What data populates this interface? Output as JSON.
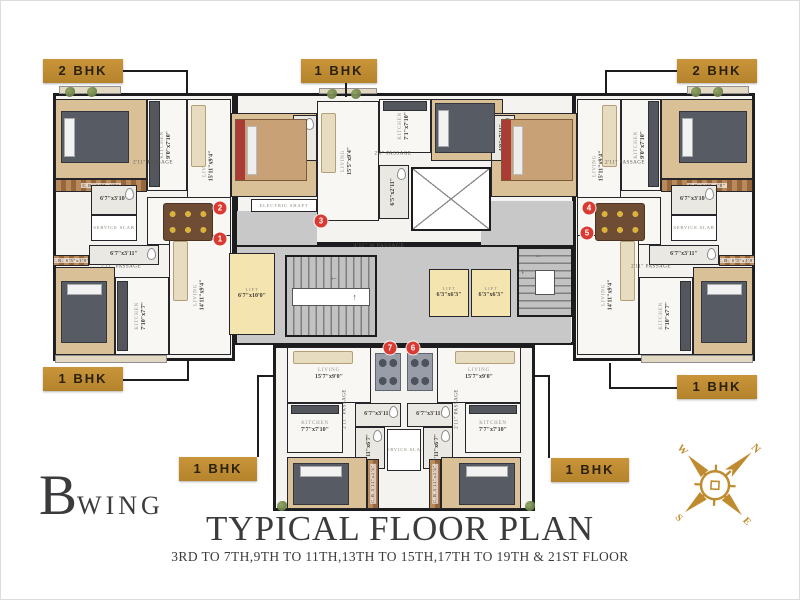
{
  "meta": {
    "wing_big": "B",
    "wing_small": "WING",
    "title": "TYPICAL FLOOR PLAN",
    "subtitle": "3RD TO 7TH,9TH TO 11TH,13TH TO 15TH,17TH TO 19TH & 21ST FLOOR"
  },
  "colors": {
    "tag_gold": "#bf8b2e",
    "wall_black": "#1d1d1f",
    "marker_red": "#d93a32",
    "wood_floor": "#d9c096",
    "lift_cream": "#f4e4b0",
    "passage_gray": "#c8c8c8",
    "title_gray": "#3b3b3e",
    "compass_gold": "#bf8b2e"
  },
  "compass": {
    "letters": {
      "n": "N",
      "e": "E",
      "s": "S",
      "w": "W"
    }
  },
  "tags": [
    {
      "label": "2 BHK",
      "x": 42,
      "y": 58,
      "w": 80,
      "h": 24,
      "lines": [
        [
          122,
          69,
          186,
          69
        ],
        [
          185,
          69,
          185,
          94
        ]
      ]
    },
    {
      "label": "1 BHK",
      "x": 300,
      "y": 58,
      "w": 76,
      "h": 24,
      "lines": [
        [
          344,
          82,
          344,
          96
        ]
      ]
    },
    {
      "label": "2 BHK",
      "x": 676,
      "y": 58,
      "w": 80,
      "h": 24,
      "lines": [
        [
          604,
          69,
          676,
          69
        ],
        [
          604,
          69,
          604,
          94
        ]
      ]
    },
    {
      "label": "1 BHK",
      "x": 42,
      "y": 366,
      "w": 80,
      "h": 24,
      "lines": [
        [
          122,
          378,
          188,
          378
        ],
        [
          186,
          360,
          186,
          378
        ]
      ]
    },
    {
      "label": "1 BHK",
      "x": 676,
      "y": 374,
      "w": 80,
      "h": 24,
      "lines": [
        [
          608,
          386,
          676,
          386
        ],
        [
          608,
          362,
          608,
          386
        ]
      ]
    },
    {
      "label": "1 BHK",
      "x": 178,
      "y": 456,
      "w": 78,
      "h": 24,
      "lines": [
        [
          256,
          374,
          256,
          456
        ],
        [
          256,
          374,
          272,
          374
        ]
      ]
    },
    {
      "label": "1 BHK",
      "x": 550,
      "y": 457,
      "w": 78,
      "h": 24,
      "lines": [
        [
          547,
          374,
          547,
          457
        ],
        [
          534,
          374,
          547,
          374
        ]
      ]
    }
  ],
  "plan": {
    "outline": [
      {
        "x": 52,
        "y": 92,
        "w": 182,
        "h": 268
      },
      {
        "x": 234,
        "y": 92,
        "w": 340,
        "h": 152
      },
      {
        "x": 572,
        "y": 92,
        "w": 182,
        "h": 268
      },
      {
        "x": 234,
        "y": 244,
        "w": 340,
        "h": 100
      },
      {
        "x": 272,
        "y": 344,
        "w": 262,
        "h": 166
      }
    ],
    "grays": [
      {
        "x": 236,
        "y": 246,
        "w": 334,
        "h": 96
      },
      {
        "x": 236,
        "y": 210,
        "w": 80,
        "h": 34
      },
      {
        "x": 480,
        "y": 200,
        "w": 92,
        "h": 44
      }
    ],
    "rooms": [
      {
        "n": "BEDROOM",
        "d": "10'0\"x9'4\"",
        "x": 54,
        "y": 98,
        "w": 92,
        "h": 80,
        "f": "wood",
        "r": 90
      },
      {
        "n": "C.B. 6'5\"x1'8\"",
        "x": 54,
        "y": 178,
        "w": 92,
        "h": 13,
        "f": "cb"
      },
      {
        "n": "KITCHEN",
        "d": "9'0\"x7'10\"",
        "x": 146,
        "y": 98,
        "w": 40,
        "h": 92,
        "f": "marble",
        "r": 90
      },
      {
        "n": "LIVING",
        "d": "15'11\"x9'4\"",
        "x": 186,
        "y": 98,
        "w": 44,
        "h": 134,
        "f": "marble",
        "r": 90
      },
      {
        "n": "BEDROOM",
        "d": "12'0\"x9'4\"",
        "x": 230,
        "y": 112,
        "w": 86,
        "h": 84,
        "f": "wood",
        "r": 90
      },
      {
        "d": "4'0\"x7'11\"",
        "x": 292,
        "y": 114,
        "w": 24,
        "h": 46,
        "f": "tile",
        "r": 90,
        "wc": 1
      },
      {
        "d": "6'7\"x3'10\"",
        "x": 90,
        "y": 184,
        "w": 46,
        "h": 30,
        "f": "tile",
        "wc": 1
      },
      {
        "n": "SERVICE SLAB",
        "x": 90,
        "y": 214,
        "w": 46,
        "h": 26,
        "f": "white"
      },
      {
        "n": "DINING",
        "d": "4'5\"x6'11\"",
        "x": 146,
        "y": 196,
        "w": 84,
        "h": 48,
        "f": "marble"
      },
      {
        "n": "ELECTRIC SHAFT",
        "x": 250,
        "y": 198,
        "w": 66,
        "h": 13,
        "f": "white"
      },
      {
        "d": "6'7\"x3'11\"",
        "x": 88,
        "y": 244,
        "w": 70,
        "h": 20,
        "f": "tile",
        "wc": 1
      },
      {
        "n": "C.B. 6'5\"x1'8\"",
        "x": 52,
        "y": 254,
        "w": 36,
        "h": 11,
        "f": "cb"
      },
      {
        "n": "BEDROOM",
        "d": "10'0\"x9'4\"",
        "x": 54,
        "y": 266,
        "w": 60,
        "h": 88,
        "f": "wood",
        "r": 90
      },
      {
        "n": "KITCHEN",
        "d": "7'10\"x7'7\"",
        "x": 114,
        "y": 276,
        "w": 54,
        "h": 78,
        "f": "marble",
        "r": 90
      },
      {
        "n": "LIVING",
        "d": "14'11\"x9'4\"",
        "x": 168,
        "y": 234,
        "w": 62,
        "h": 120,
        "f": "marble",
        "r": 90
      },
      {
        "n": "LIVING",
        "d": "15'5\"x9'4\"",
        "x": 316,
        "y": 100,
        "w": 62,
        "h": 120,
        "f": "marble",
        "r": 90
      },
      {
        "n": "KITCHEN",
        "d": "7'1\"x7'10\"",
        "x": 378,
        "y": 98,
        "w": 52,
        "h": 54,
        "f": "marble",
        "r": 90
      },
      {
        "n": "BEDROOM",
        "d": "10'0\"x9'4\"",
        "x": 430,
        "y": 98,
        "w": 72,
        "h": 62,
        "f": "wood",
        "r": 90
      },
      {
        "d": "6'5\"x2'11\"",
        "x": 378,
        "y": 164,
        "w": 30,
        "h": 54,
        "f": "tile",
        "r": 90,
        "wc": 1
      },
      {
        "n": "BEDROOM",
        "d": "10'0\"x9'4\"",
        "x": 660,
        "y": 98,
        "w": 92,
        "h": 80,
        "f": "wood",
        "r": 90
      },
      {
        "n": "C.B. 6'5\"x1'8\"",
        "x": 660,
        "y": 178,
        "w": 92,
        "h": 13,
        "f": "cb"
      },
      {
        "n": "KITCHEN",
        "d": "9'0\"x7'10\"",
        "x": 620,
        "y": 98,
        "w": 40,
        "h": 92,
        "f": "marble",
        "r": 90
      },
      {
        "n": "LIVING",
        "d": "15'11\"x9'4\"",
        "x": 576,
        "y": 98,
        "w": 44,
        "h": 134,
        "f": "marble",
        "r": 90
      },
      {
        "n": "BEDROOM",
        "d": "12'0\"x9'4\"",
        "x": 490,
        "y": 112,
        "w": 86,
        "h": 84,
        "f": "wood",
        "r": 90
      },
      {
        "d": "4'0\"x7'11\"",
        "x": 490,
        "y": 114,
        "w": 24,
        "h": 46,
        "f": "tile",
        "r": 90,
        "wc": 1
      },
      {
        "d": "6'7\"x3'10\"",
        "x": 670,
        "y": 184,
        "w": 46,
        "h": 30,
        "f": "tile",
        "wc": 1
      },
      {
        "n": "SERVICE SLAB",
        "x": 670,
        "y": 214,
        "w": 46,
        "h": 26,
        "f": "white"
      },
      {
        "n": "DINING",
        "d": "4'5\"x6'11\"",
        "x": 576,
        "y": 196,
        "w": 84,
        "h": 48,
        "f": "marble"
      },
      {
        "d": "6'7\"x3'11\"",
        "x": 648,
        "y": 244,
        "w": 70,
        "h": 20,
        "f": "tile",
        "wc": 1
      },
      {
        "n": "C.B. 6'5\"x1'8\"",
        "x": 718,
        "y": 254,
        "w": 36,
        "h": 11,
        "f": "cb"
      },
      {
        "n": "BEDROOM",
        "d": "10'0\"x9'4\"",
        "x": 692,
        "y": 266,
        "w": 60,
        "h": 88,
        "f": "wood",
        "r": 90
      },
      {
        "n": "KITCHEN",
        "d": "7'10\"x7'7\"",
        "x": 638,
        "y": 276,
        "w": 54,
        "h": 78,
        "f": "marble",
        "r": 90
      },
      {
        "n": "LIVING",
        "d": "14'11\"x9'4\"",
        "x": 576,
        "y": 234,
        "w": 62,
        "h": 120,
        "f": "marble",
        "r": 90
      },
      {
        "n": "LIFT",
        "d": "6'7\"x10'0\"",
        "x": 228,
        "y": 252,
        "w": 46,
        "h": 82,
        "f": "lift"
      },
      {
        "n": "LIFT",
        "d": "6'3\"x6'3\"",
        "x": 428,
        "y": 268,
        "w": 40,
        "h": 48,
        "f": "lift"
      },
      {
        "n": "LIFT",
        "d": "6'3\"x6'3\"",
        "x": 470,
        "y": 268,
        "w": 40,
        "h": 48,
        "f": "lift"
      },
      {
        "n": "LIVING",
        "d": "15'7\"x9'0\"",
        "x": 286,
        "y": 346,
        "w": 84,
        "h": 56,
        "f": "marble"
      },
      {
        "n": "KITCHEN",
        "d": "7'7\"x7'10\"",
        "x": 286,
        "y": 402,
        "w": 56,
        "h": 50,
        "f": "marble"
      },
      {
        "d": "6'7\"x3'11\"",
        "x": 354,
        "y": 402,
        "w": 46,
        "h": 24,
        "f": "tile",
        "wc": 1
      },
      {
        "d": "3'11\"x6'7\"",
        "x": 354,
        "y": 426,
        "w": 30,
        "h": 42,
        "f": "tile",
        "r": 90,
        "wc": 1
      },
      {
        "n": "BEDROOM",
        "d": "10'0\"x9'0\"",
        "x": 286,
        "y": 456,
        "w": 80,
        "h": 52,
        "f": "wood"
      },
      {
        "n": "C.B 5'11\"x1'6\"",
        "x": 366,
        "y": 458,
        "w": 12,
        "h": 50,
        "f": "cb",
        "r": 90
      },
      {
        "n": "SERVICE SLAB",
        "x": 386,
        "y": 428,
        "w": 34,
        "h": 42,
        "f": "white"
      },
      {
        "n": "LIVING",
        "d": "15'7\"x9'0\"",
        "x": 436,
        "y": 346,
        "w": 84,
        "h": 56,
        "f": "marble"
      },
      {
        "n": "KITCHEN",
        "d": "7'7\"x7'10\"",
        "x": 464,
        "y": 402,
        "w": 56,
        "h": 50,
        "f": "marble"
      },
      {
        "d": "6'7\"x3'11\"",
        "x": 406,
        "y": 402,
        "w": 46,
        "h": 24,
        "f": "tile",
        "wc": 1
      },
      {
        "d": "3'11\"x6'7\"",
        "x": 422,
        "y": 426,
        "w": 30,
        "h": 42,
        "f": "tile",
        "r": 90,
        "wc": 1
      },
      {
        "n": "BEDROOM",
        "d": "10'0\"x9'0\"",
        "x": 440,
        "y": 456,
        "w": 80,
        "h": 52,
        "f": "wood"
      },
      {
        "n": "C.B 5'11\"x1'6\"",
        "x": 428,
        "y": 458,
        "w": 12,
        "h": 50,
        "f": "cb",
        "r": 90
      },
      {
        "x": 58,
        "y": 85,
        "w": 62,
        "h": 8,
        "f": "balcony"
      },
      {
        "x": 318,
        "y": 87,
        "w": 58,
        "h": 6,
        "f": "balcony"
      },
      {
        "x": 686,
        "y": 85,
        "w": 62,
        "h": 8,
        "f": "balcony"
      },
      {
        "x": 54,
        "y": 354,
        "w": 112,
        "h": 8,
        "f": "balcony"
      },
      {
        "x": 640,
        "y": 354,
        "w": 112,
        "h": 8,
        "f": "balcony"
      }
    ],
    "features": [
      {
        "k": "bed",
        "x": 60,
        "y": 110,
        "w": 68,
        "h": 52
      },
      {
        "k": "bedred",
        "x": 234,
        "y": 118,
        "w": 72,
        "h": 62
      },
      {
        "k": "bed",
        "x": 678,
        "y": 110,
        "w": 68,
        "h": 52
      },
      {
        "k": "bedred",
        "x": 500,
        "y": 118,
        "w": 72,
        "h": 62
      },
      {
        "k": "bedv",
        "x": 60,
        "y": 280,
        "w": 46,
        "h": 62
      },
      {
        "k": "bedv",
        "x": 700,
        "y": 280,
        "w": 46,
        "h": 62
      },
      {
        "k": "bed",
        "x": 434,
        "y": 102,
        "w": 60,
        "h": 50
      },
      {
        "k": "bedv",
        "x": 292,
        "y": 462,
        "w": 56,
        "h": 42
      },
      {
        "k": "bedv",
        "x": 458,
        "y": 462,
        "w": 56,
        "h": 42
      },
      {
        "k": "table6",
        "x": 162,
        "y": 202,
        "w": 50,
        "h": 38
      },
      {
        "k": "table6",
        "x": 594,
        "y": 202,
        "w": 50,
        "h": 38
      },
      {
        "k": "tableg",
        "x": 374,
        "y": 352,
        "w": 26,
        "h": 38
      },
      {
        "k": "tableg",
        "x": 406,
        "y": 352,
        "w": 26,
        "h": 38
      },
      {
        "k": "sofa",
        "x": 190,
        "y": 104,
        "w": 15,
        "h": 62
      },
      {
        "k": "sofa",
        "x": 601,
        "y": 104,
        "w": 15,
        "h": 62
      },
      {
        "k": "sofa",
        "x": 320,
        "y": 112,
        "w": 15,
        "h": 60
      },
      {
        "k": "sofa",
        "x": 172,
        "y": 240,
        "w": 15,
        "h": 60
      },
      {
        "k": "sofa",
        "x": 619,
        "y": 240,
        "w": 15,
        "h": 60
      },
      {
        "k": "sofah",
        "x": 292,
        "y": 350,
        "w": 60,
        "h": 13
      },
      {
        "k": "sofah",
        "x": 454,
        "y": 350,
        "w": 60,
        "h": 13
      },
      {
        "k": "counter",
        "x": 148,
        "y": 100,
        "w": 11,
        "h": 86
      },
      {
        "k": "counter",
        "x": 647,
        "y": 100,
        "w": 11,
        "h": 86
      },
      {
        "k": "counter",
        "x": 116,
        "y": 280,
        "w": 11,
        "h": 70
      },
      {
        "k": "counter",
        "x": 679,
        "y": 280,
        "w": 11,
        "h": 70
      },
      {
        "k": "counterh",
        "x": 382,
        "y": 100,
        "w": 44,
        "h": 10
      },
      {
        "k": "counterh",
        "x": 290,
        "y": 404,
        "w": 48,
        "h": 9
      },
      {
        "k": "counterh",
        "x": 468,
        "y": 404,
        "w": 48,
        "h": 9
      },
      {
        "k": "stairv",
        "x": 284,
        "y": 254,
        "w": 92,
        "h": 82
      },
      {
        "k": "stairh",
        "x": 516,
        "y": 246,
        "w": 56,
        "h": 70
      },
      {
        "k": "duct",
        "x": 410,
        "y": 166,
        "w": 80,
        "h": 64
      },
      {
        "k": "plant",
        "x": 64,
        "y": 86
      },
      {
        "k": "plant",
        "x": 86,
        "y": 86
      },
      {
        "k": "plant",
        "x": 326,
        "y": 88
      },
      {
        "k": "plant",
        "x": 350,
        "y": 88
      },
      {
        "k": "plant",
        "x": 690,
        "y": 86
      },
      {
        "k": "plant",
        "x": 712,
        "y": 86
      },
      {
        "k": "plant",
        "x": 276,
        "y": 500
      },
      {
        "k": "plant",
        "x": 524,
        "y": 500
      }
    ],
    "texts": [
      {
        "t": "2'11\" PASSAGE",
        "x": 152,
        "y": 162
      },
      {
        "t": "2'11\" PASSAGE",
        "x": 120,
        "y": 266
      },
      {
        "t": "2'11\" PASSAGE",
        "x": 624,
        "y": 162
      },
      {
        "t": "2'11\" PASSAGE",
        "x": 650,
        "y": 266
      },
      {
        "t": "2'0\" PASSAGE",
        "x": 392,
        "y": 153
      },
      {
        "t": "4'11\" W PASSAGE",
        "x": 378,
        "y": 245,
        "fs": 5.5
      },
      {
        "t": "2'11\" PASSAGE",
        "x": 344,
        "y": 408,
        "r": 90
      },
      {
        "t": "2'11\" PASSAGE",
        "x": 456,
        "y": 408,
        "r": 90
      },
      {
        "t": "←",
        "x": 333,
        "y": 276,
        "fs": 9
      },
      {
        "t": "↑",
        "x": 354,
        "y": 296,
        "fs": 9
      },
      {
        "t": "←",
        "x": 538,
        "y": 254,
        "fs": 8
      },
      {
        "t": "↓",
        "x": 522,
        "y": 270,
        "fs": 8
      }
    ],
    "markers": [
      {
        "n": "1",
        "x": 219,
        "y": 238
      },
      {
        "n": "2",
        "x": 219,
        "y": 207
      },
      {
        "n": "3",
        "x": 320,
        "y": 220
      },
      {
        "n": "4",
        "x": 588,
        "y": 207
      },
      {
        "n": "5",
        "x": 586,
        "y": 232
      },
      {
        "n": "6",
        "x": 412,
        "y": 347
      },
      {
        "n": "7",
        "x": 389,
        "y": 347
      }
    ]
  }
}
